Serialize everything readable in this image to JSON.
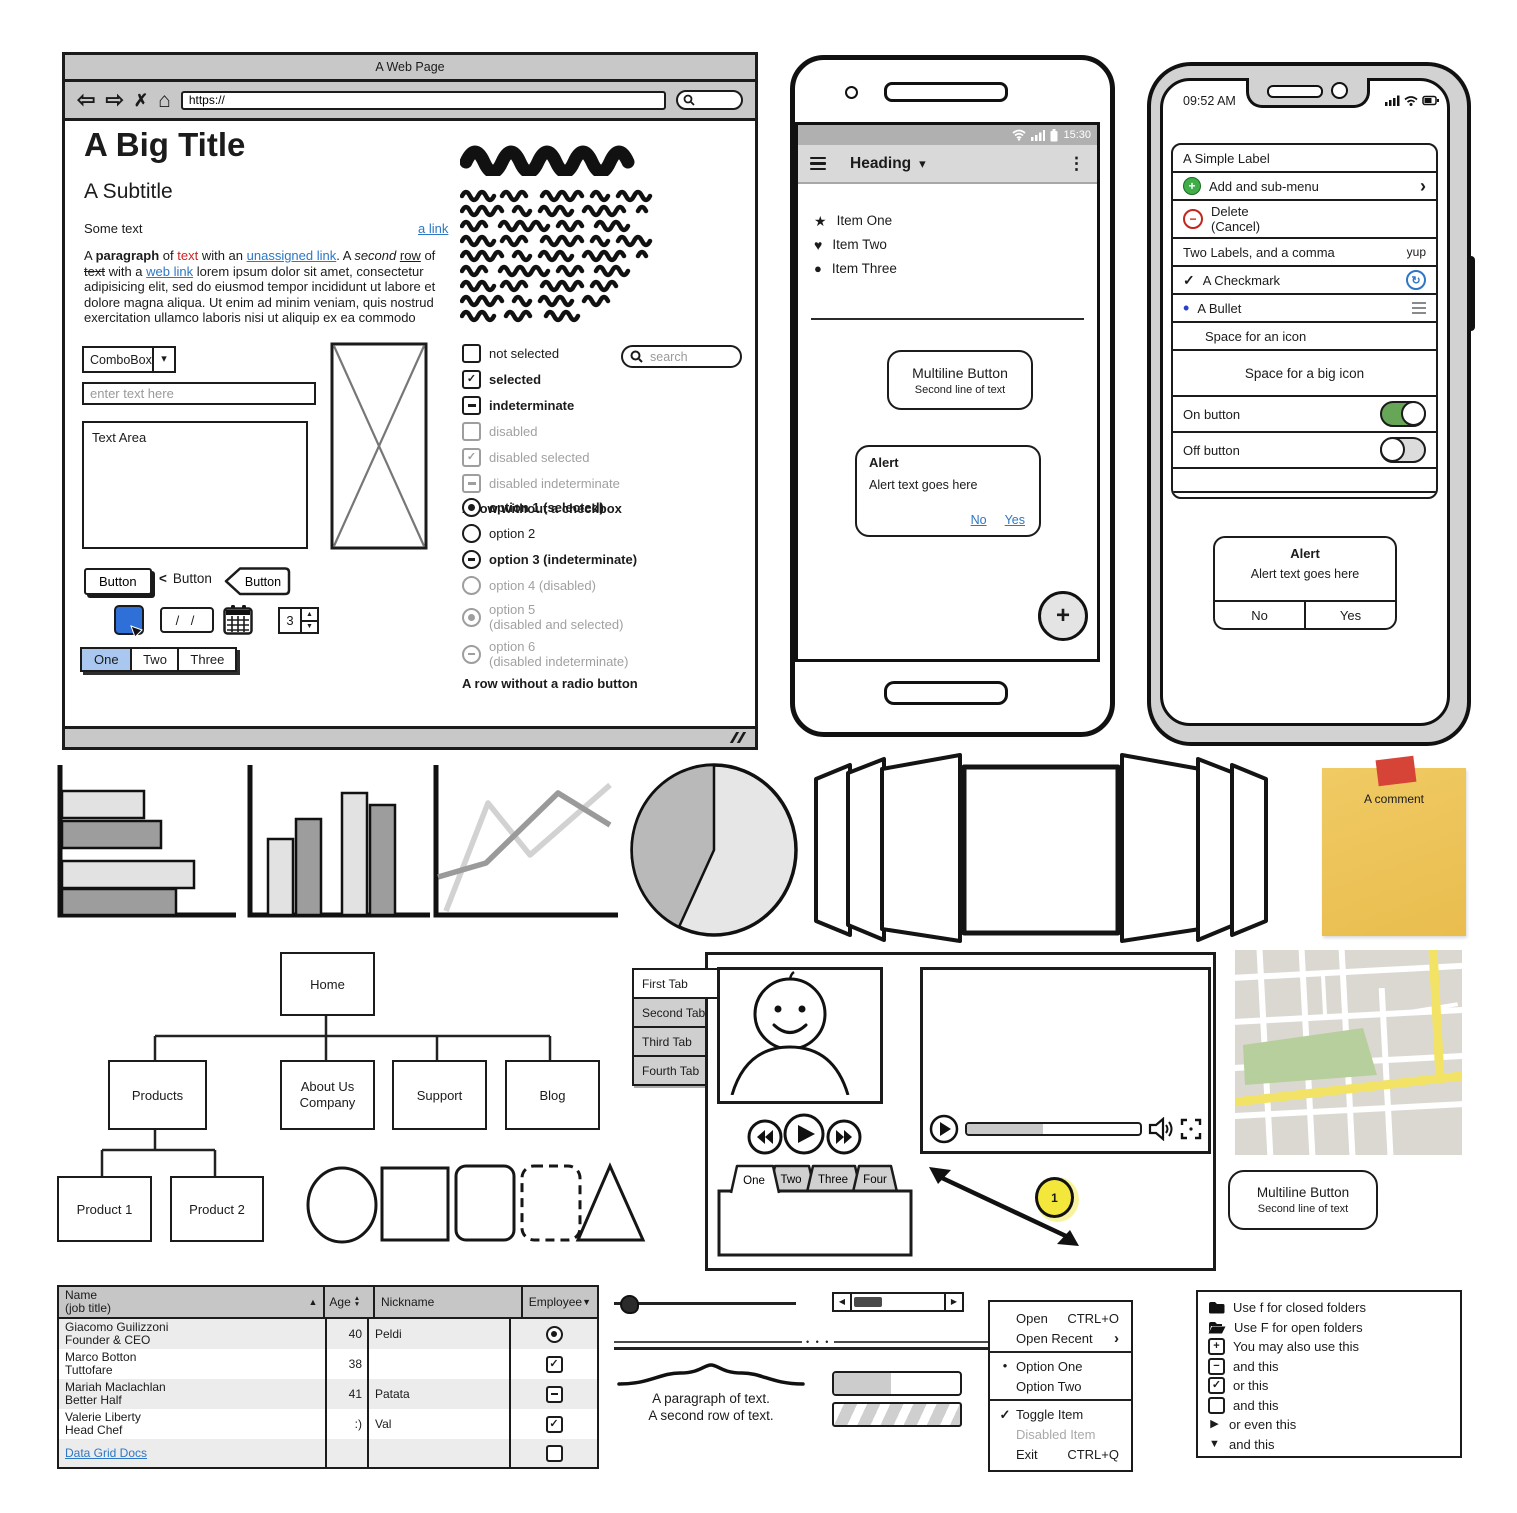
{
  "icons": {
    "check": "✓",
    "minus": "−",
    "plus": "+",
    "star": "★",
    "heart": "♥",
    "dot": "●",
    "bullet": "•",
    "kebab": "⋮",
    "caret_down": "▾",
    "chevron_right": "›",
    "chevron_left": "<",
    "tri_up": "▲",
    "tri_down": "▼",
    "tri_left": "◀",
    "tri_right": "▶",
    "arrow_back": "⇦",
    "arrow_forward": "⇨",
    "close": "✗",
    "home": "⌂",
    "sync": "↻",
    "dots3": "•  •  •"
  },
  "colors": {
    "accent_blue": "#2e6fd8",
    "link_blue": "#2d77c5",
    "selected_tab_blue": "#a9c7ef",
    "toggle_green": "#67a557",
    "note_yellow": "#edc45c",
    "tape_red": "#d64438",
    "badge_yellow": "#f4e73c",
    "chrome_gray": "#c8c8c8",
    "map_road_yellow": "#f2e366",
    "map_park_green": "#b7cf9d"
  },
  "browser": {
    "window_title": "A Web Page",
    "url": "https://",
    "search_placeholder": "search",
    "big_title": "A Big Title",
    "subtitle": "A Subtitle",
    "some_text": "Some text",
    "a_link": "a link",
    "para": {
      "a": "A ",
      "b": "paragraph",
      "c": " of ",
      "d": "text",
      "e": " with an ",
      "f": "unassigned link",
      "g": ". A ",
      "h": "second",
      "i": " ",
      "j": "row",
      "k": " of ",
      "l": "text",
      "m": " with a ",
      "n": "web link",
      "o": " lorem ipsum dolor sit amet, consectetur adipisicing elit, sed do eiusmod tempor incididunt ut labore et dolore magna aliqua. Ut enim ad minim veniam, quis nostrud exercitation ullamco laboris nisi ut aliquip ex ea commodo"
    },
    "combobox_label": "ComboBox",
    "input_placeholder": "enter text here",
    "textarea_label": "Text Area",
    "checkboxes": [
      {
        "label": "not selected"
      },
      {
        "label": "selected"
      },
      {
        "label": "indeterminate"
      },
      {
        "label": "disabled"
      },
      {
        "label": "disabled selected"
      },
      {
        "label": "disabled indeterminate"
      }
    ],
    "checkbox_footer": "A row without a checkbox",
    "radios": [
      {
        "label": "option 1 (selected)"
      },
      {
        "label": "option 2"
      },
      {
        "label": "option 3 (indeterminate)"
      },
      {
        "label": "option 4 (disabled)"
      },
      {
        "label": "option 5",
        "label2": "(disabled and selected)"
      },
      {
        "label": "option 6",
        "label2": "(disabled indeterminate)"
      }
    ],
    "radio_footer": "A row without a radio button",
    "button_default": "Button",
    "button_link": "Button",
    "button_arrow": "Button",
    "date_value": "/ /",
    "stepper_value": "3",
    "tabs": [
      "One",
      "Two",
      "Three"
    ]
  },
  "android": {
    "time": "15:30",
    "heading": "Heading",
    "items": [
      {
        "label": "Item One"
      },
      {
        "label": "Item Two"
      },
      {
        "label": "Item Three"
      }
    ],
    "button": {
      "line1": "Multiline Button",
      "line2": "Second line of text"
    },
    "alert": {
      "title": "Alert",
      "text": "Alert text goes here",
      "no": "No",
      "yes": "Yes"
    }
  },
  "iphone": {
    "time": "09:52 AM",
    "rows": {
      "simple_label": "A Simple Label",
      "add": "Add and sub-menu",
      "delete1": "Delete",
      "delete2": "(Cancel)",
      "two_labels": "Two Labels, and a comma",
      "two_labels_right": "yup",
      "checkmark": "A Checkmark",
      "bullet": "A Bullet",
      "space_icon": "Space for an icon",
      "space_big_icon": "Space for a big icon",
      "on": "On button",
      "off": "Off button",
      "empty_row": "An empty row",
      "empty_row_right": "(above)"
    },
    "alert": {
      "title": "Alert",
      "text": "Alert text goes here",
      "no": "No",
      "yes": "Yes"
    }
  },
  "note": {
    "label": "A comment"
  },
  "sitemap": {
    "home": "Home",
    "products": "Products",
    "about1": "About Us",
    "about2": "Company",
    "support": "Support",
    "blog": "Blog",
    "p1": "Product 1",
    "p2": "Product 2"
  },
  "side_tabs": [
    "First Tab",
    "Second Tab",
    "Third Tab",
    "Fourth Tab"
  ],
  "folder_tabs": [
    "One",
    "Two",
    "Three",
    "Four"
  ],
  "badge": "1",
  "multiline_button": {
    "line1": "Multiline Button",
    "line2": "Second line of text"
  },
  "grid": {
    "h_name1": "Name",
    "h_name2": "(job title)",
    "h_age": "Age",
    "h_nick": "Nickname",
    "h_emp": "Employee",
    "rows": [
      {
        "name": "Giacomo Guilizzoni",
        "job": "Founder & CEO",
        "age": "40",
        "nick": "Peldi"
      },
      {
        "name": "Marco Botton",
        "job": "Tuttofare",
        "age": "38",
        "nick": ""
      },
      {
        "name": "Mariah Maclachlan",
        "job": "Better Half",
        "age": "41",
        "nick": "Patata"
      },
      {
        "name": "Valerie Liberty",
        "job": "Head Chef",
        "age": ":)",
        "nick": "Val"
      }
    ],
    "docs_link": "Data Grid Docs"
  },
  "paragraph_widget": {
    "line1": "A paragraph of text.",
    "line2": "A second row of text."
  },
  "menu": {
    "open": "Open",
    "open_sc": "CTRL+O",
    "recent": "Open Recent",
    "opt1": "Option One",
    "opt2": "Option Two",
    "toggle": "Toggle Item",
    "disabled": "Disabled Item",
    "exit": "Exit",
    "exit_sc": "CTRL+Q"
  },
  "tree": {
    "r1": "Use f for closed folders",
    "r2": "Use F for open folders",
    "r3": "You may also use this",
    "r4": "and this",
    "r5": "or this",
    "r6": "and this",
    "r7": "or even this",
    "r8": "and this",
    "r9": "Use _ for a file icon"
  },
  "chart_data": [
    {
      "type": "bar",
      "orientation": "horizontal",
      "values": [
        0.45,
        0.55,
        0.73,
        0.63
      ],
      "colors": [
        "#e2e2e2",
        "#9d9d9d",
        "#e2e2e2",
        "#9d9d9d"
      ],
      "title": ""
    },
    {
      "type": "bar",
      "orientation": "vertical",
      "values": [
        0.5,
        0.63,
        0.8,
        0.73
      ],
      "colors": [
        "#e2e2e2",
        "#9d9d9d",
        "#e2e2e2",
        "#9d9d9d"
      ],
      "title": ""
    },
    {
      "type": "line",
      "series": [
        {
          "name": "light",
          "y": [
            0.05,
            0.75,
            0.4,
            0.87
          ]
        },
        {
          "name": "dark",
          "y": [
            0.25,
            0.35,
            0.82,
            0.6
          ]
        }
      ],
      "title": ""
    },
    {
      "type": "pie",
      "values": [
        43,
        57
      ],
      "colors": [
        "#b9b9b9",
        "#e6e6e6"
      ],
      "title": ""
    }
  ]
}
